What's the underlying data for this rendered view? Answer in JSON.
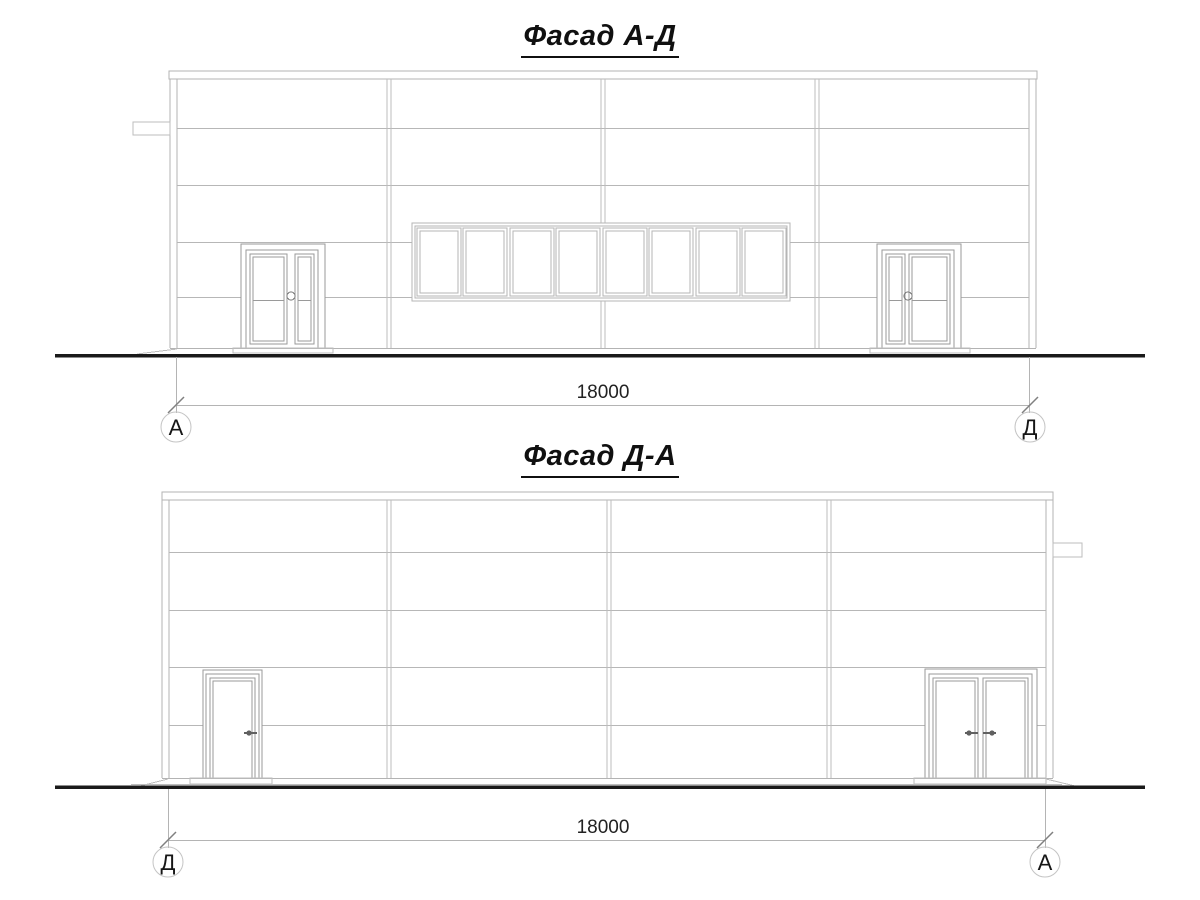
{
  "drawing_type": "architectural elevations",
  "facades": {
    "top": {
      "title": "Фасад А-Д",
      "dimension": "18000",
      "axis_left": "А",
      "axis_right": "Д"
    },
    "bottom": {
      "title": "Фасад Д-А",
      "dimension": "18000",
      "axis_left": "Д",
      "axis_right": "А"
    }
  },
  "colors": {
    "background": "#ffffff",
    "drawing_line": "#b3b3b3",
    "door_line": "#9a9a9a",
    "ground_line": "#1a1a1a",
    "dimension_line": "#b4b4b4",
    "tick_mark": "#808080",
    "text": "#111111"
  }
}
